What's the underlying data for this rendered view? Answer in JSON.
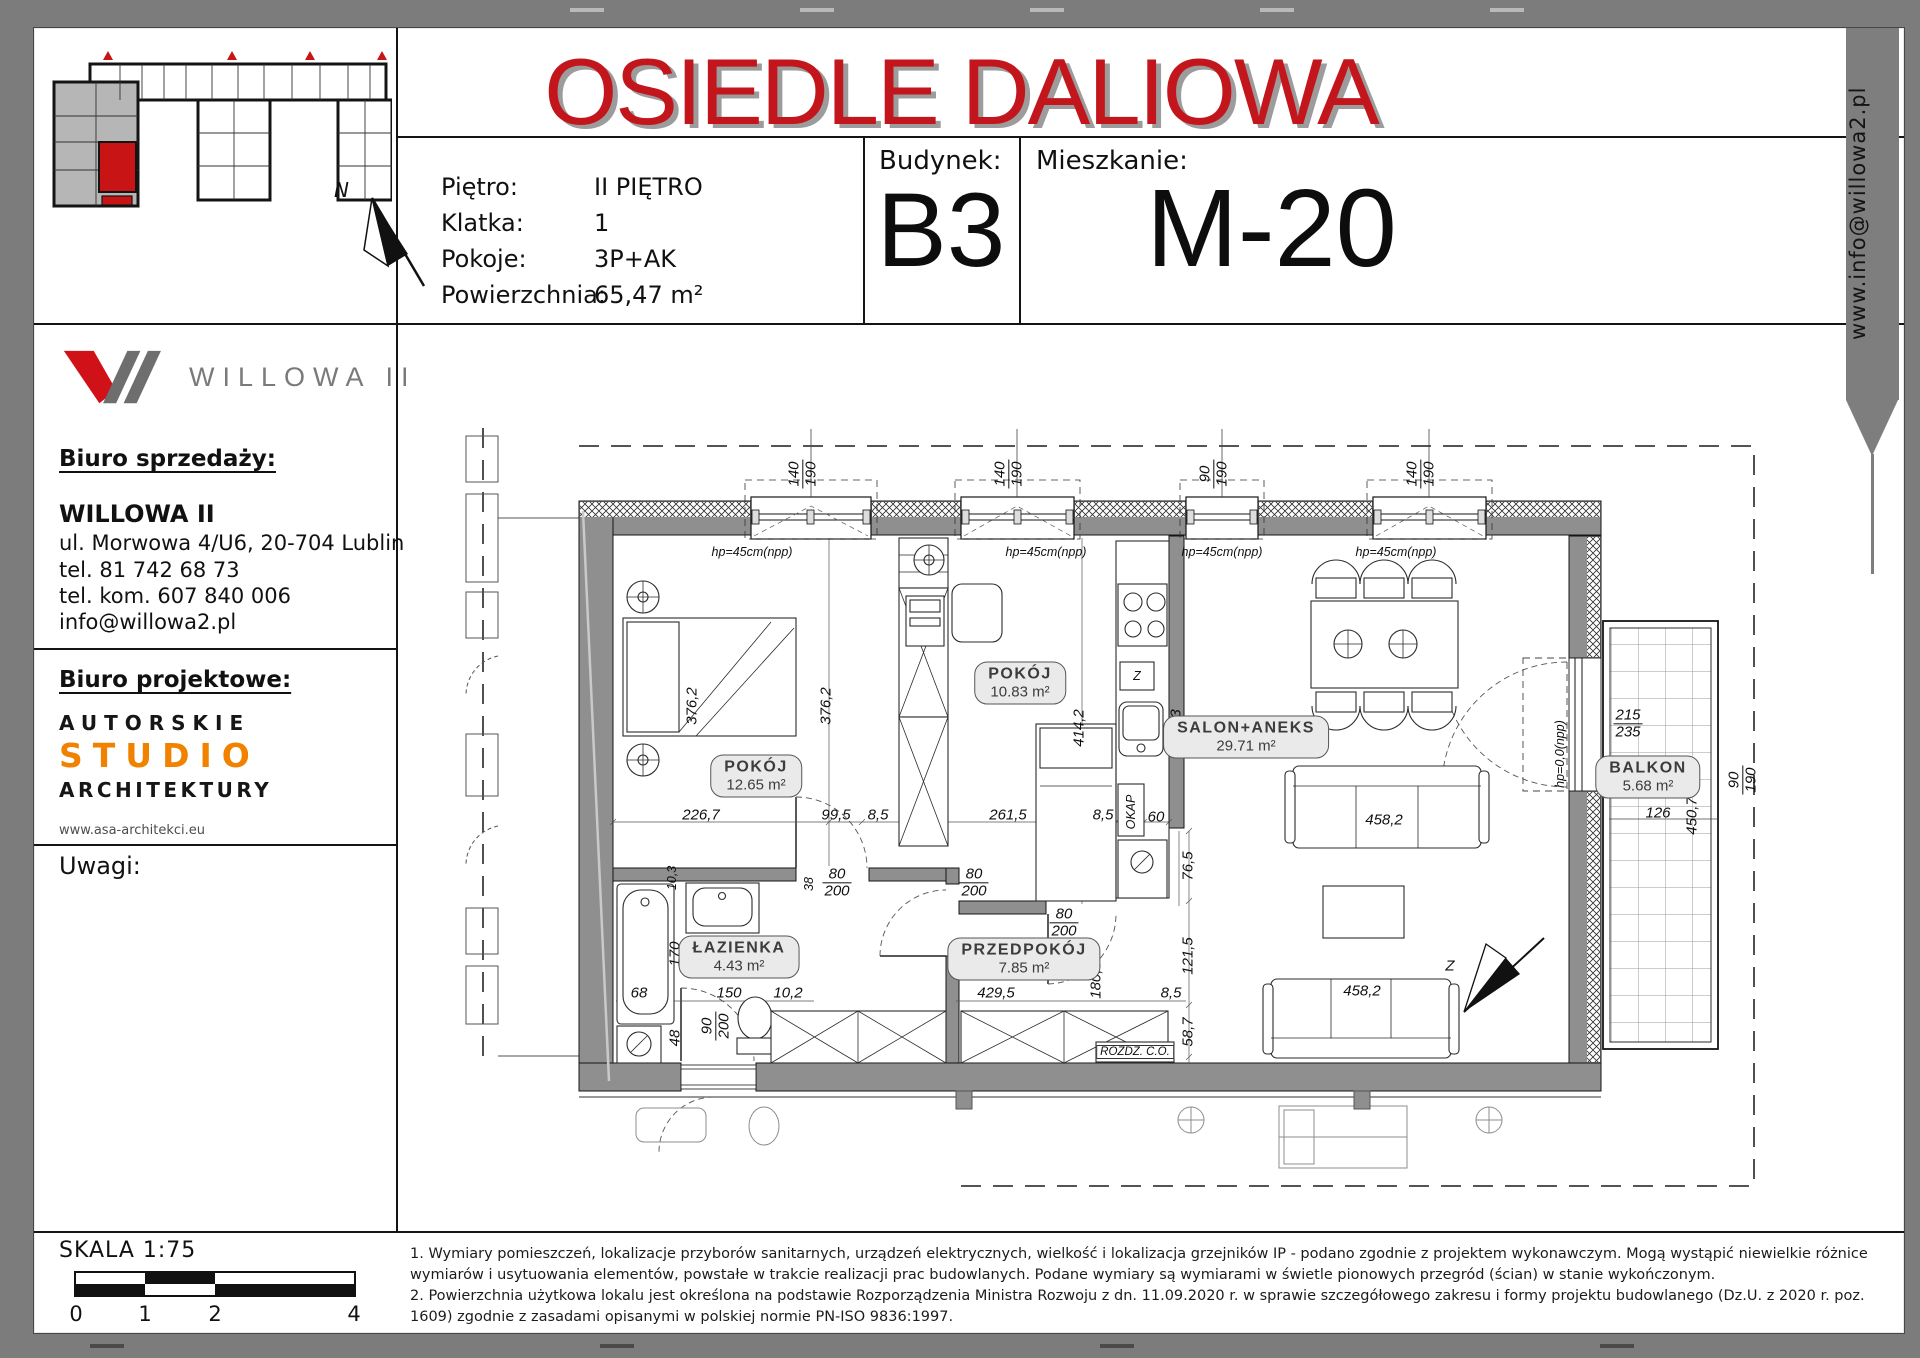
{
  "title": "OSIEDLE DALIOWA",
  "ribbon_text": "www.info@willowa2.pl",
  "header": {
    "fields": [
      {
        "label": "Piętro:",
        "value": "II PIĘTRO"
      },
      {
        "label": "Klatka:",
        "value": "1"
      },
      {
        "label": "Pokoje:",
        "value": "3P+AK"
      },
      {
        "label": "Powierzchnia:",
        "value": "65,47 m²"
      }
    ],
    "building": {
      "label": "Budynek:",
      "value": "B3"
    },
    "apartment": {
      "label": "Mieszkanie:",
      "value": "M-20"
    }
  },
  "sidebar": {
    "logo_text": "WILLOWA II",
    "compass_letter": "N",
    "sales_office": {
      "heading": "Biuro sprzedaży:",
      "company": "WILLOWA II",
      "address": "ul. Morwowa 4/U6, 20-704 Lublin",
      "phone": "tel. 81 742 68 73",
      "mobile": "tel. kom. 607 840 006",
      "email": "info@willowa2.pl"
    },
    "design_office": {
      "heading": "Biuro projektowe:",
      "line1": "AUTORSKIE",
      "line2": "STUDIO",
      "line3": "ARCHITEKTURY",
      "website": "www.asa-architekci.eu"
    },
    "notes_heading": "Uwagi:",
    "scale": {
      "label": "SKALA 1:75",
      "ticks": [
        "0",
        "1",
        "2",
        "4"
      ]
    }
  },
  "plan": {
    "rooms": [
      {
        "name": "POKÓJ",
        "area": "12.65 m²",
        "x": 360,
        "y": 510
      },
      {
        "name": "POKÓJ",
        "area": "10.83 m²",
        "x": 624,
        "y": 417
      },
      {
        "name": "SALON+ANEKS",
        "area": "29.71 m²",
        "x": 850,
        "y": 471
      },
      {
        "name": "ŁAZIENKA",
        "area": "4.43 m²",
        "x": 343,
        "y": 691
      },
      {
        "name": "PRZEDPOKÓJ",
        "area": "7.85 m²",
        "x": 628,
        "y": 693
      },
      {
        "name": "BALKON",
        "area": "5.68 m²",
        "x": 1252,
        "y": 511
      }
    ],
    "dims": [
      {
        "t": "140/190",
        "x": 407,
        "y": 208,
        "rot": 1,
        "frac": 1
      },
      {
        "t": "140/190",
        "x": 613,
        "y": 208,
        "rot": 1,
        "frac": 1
      },
      {
        "t": "90/190",
        "x": 818,
        "y": 208,
        "rot": 1,
        "frac": 1
      },
      {
        "t": "140/190",
        "x": 1025,
        "y": 208,
        "rot": 1,
        "frac": 1
      },
      {
        "t": "hp=45cm(npp)",
        "x": 356,
        "y": 286,
        "sm": 1
      },
      {
        "t": "hp=45cm(npp)",
        "x": 650,
        "y": 286,
        "sm": 1
      },
      {
        "t": "hp=45cm(npp)",
        "x": 826,
        "y": 286,
        "sm": 1
      },
      {
        "t": "hp=45cm(npp)",
        "x": 1000,
        "y": 286,
        "sm": 1
      },
      {
        "t": "376,2",
        "x": 296,
        "y": 440,
        "rot": 1
      },
      {
        "t": "376,2",
        "x": 430,
        "y": 440,
        "rot": 1
      },
      {
        "t": "414,2",
        "x": 683,
        "y": 462,
        "rot": 1
      },
      {
        "t": "346,3",
        "x": 780,
        "y": 462,
        "rot": 1
      },
      {
        "t": "226,7",
        "x": 305,
        "y": 549
      },
      {
        "t": "99,5",
        "x": 440,
        "y": 549
      },
      {
        "t": "8,5",
        "x": 482,
        "y": 549
      },
      {
        "t": "261,5",
        "x": 612,
        "y": 549
      },
      {
        "t": "8,5",
        "x": 707,
        "y": 549
      },
      {
        "t": "60",
        "x": 760,
        "y": 551
      },
      {
        "t": "OKAP",
        "x": 735,
        "y": 546,
        "rot": 1,
        "sm": 1
      },
      {
        "t": "Z",
        "x": 741,
        "y": 410,
        "sm": 1
      },
      {
        "t": "10,3",
        "x": 276,
        "y": 612,
        "rot": 1,
        "sm": 1
      },
      {
        "t": "38",
        "x": 413,
        "y": 618,
        "rot": 1,
        "sm": 1
      },
      {
        "t": "80/200",
        "x": 441,
        "y": 617,
        "frac": 1
      },
      {
        "t": "80/200",
        "x": 578,
        "y": 617,
        "frac": 1
      },
      {
        "t": "80/200",
        "x": 668,
        "y": 657,
        "frac": 1
      },
      {
        "t": "170",
        "x": 279,
        "y": 688,
        "rot": 1
      },
      {
        "t": "68",
        "x": 243,
        "y": 727
      },
      {
        "t": "150",
        "x": 333,
        "y": 727
      },
      {
        "t": "10,2",
        "x": 392,
        "y": 727
      },
      {
        "t": "48",
        "x": 279,
        "y": 772,
        "rot": 1
      },
      {
        "t": "90/200",
        "x": 320,
        "y": 760,
        "rot": 1,
        "frac": 1
      },
      {
        "t": "429,5",
        "x": 600,
        "y": 727
      },
      {
        "t": "180,3",
        "x": 700,
        "y": 714,
        "rot": 1
      },
      {
        "t": "8,5",
        "x": 775,
        "y": 727
      },
      {
        "t": "76,5",
        "x": 792,
        "y": 600,
        "rot": 1
      },
      {
        "t": "121,5",
        "x": 792,
        "y": 690,
        "rot": 1
      },
      {
        "t": "58,7",
        "x": 792,
        "y": 766,
        "rot": 1
      },
      {
        "t": "458,2",
        "x": 988,
        "y": 554
      },
      {
        "t": "458,2",
        "x": 966,
        "y": 725
      },
      {
        "t": "hp=0,0(npp)",
        "x": 1164,
        "y": 488,
        "rot": 1,
        "sm": 1
      },
      {
        "t": "215/235",
        "x": 1232,
        "y": 458,
        "frac": 1
      },
      {
        "t": "126",
        "x": 1262,
        "y": 547
      },
      {
        "t": "450,7",
        "x": 1296,
        "y": 550,
        "rot": 1
      },
      {
        "t": "90/190",
        "x": 1347,
        "y": 514,
        "rot": 1,
        "frac": 1
      },
      {
        "t": "ROZDZ. C.O.",
        "x": 739,
        "y": 786,
        "box": 1,
        "sm": 1
      },
      {
        "t": "Z",
        "x": 1054,
        "y": 700
      }
    ]
  },
  "footer": {
    "note1": "1. Wymiary pomieszczeń, lokalizacje przyborów sanitarnych, urządzeń elektrycznych, wielkość i lokalizacja grzejników IP - podano zgodnie z projektem wykonawczym. Mogą wystąpić niewielkie różnice wymiarów i usytuowania elementów, powstałe w trakcie realizacji prac budowlanych. Podane wymiary są wymiarami w świetle pionowych przegród (ścian) w stanie wykończonym.",
    "note2": "2. Powierzchnia użytkowa lokalu jest określona na podstawie Rozporządzenia Ministra Rozwoju z dn. 11.09.2020 r. w sprawie szczegółowego zakresu i formy projektu budowlanego (Dz.U. z 2020 r. poz. 1609) zgodnie z zasadami opisanymi w polskiej normie PN-ISO 9836:1997."
  },
  "colors": {
    "accent_red": "#c3161c",
    "logo_red": "#d01218",
    "studio_orange": "#f08200",
    "wall_gray": "#8f8f8f",
    "highlight_red": "#c81414"
  }
}
